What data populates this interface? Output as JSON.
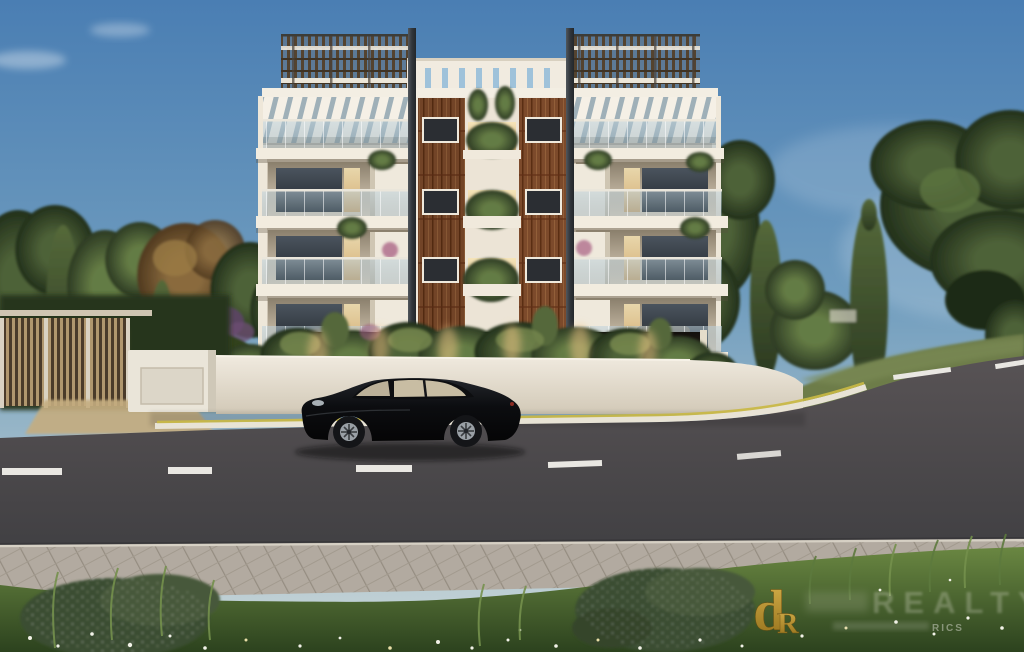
{
  "scene": {
    "subject": "Architectural rendering of a modern four-storey apartment building with wood-clad core, white balconies, roof pergolas, landscaped garden, entrance gate, and a black luxury coupe parked on the street in front"
  },
  "watermark": {
    "monogram_d": "d",
    "monogram_r": "R",
    "brand_text": "REALTY",
    "small_text": "RICS"
  },
  "colors": {
    "sky_top": "#4a7eb3",
    "sky_horizon": "#c9d6d8",
    "building_white": "#f1ebdf",
    "wood_cladding": "#7c4a2b",
    "steel_column": "#383d42",
    "glass_railing": "#9db7c6",
    "warm_interior_light": "#f0d29a",
    "foliage_dark": "#2c3a23",
    "foliage_light": "#74864c",
    "autumn_foliage": "#8a6b3e",
    "asphalt": "#4c4b4e",
    "sidewalk": "#b2aaa0",
    "grass": "#4c6631",
    "curb_line_yellow": "#c9b944",
    "car_black": "#0b0c0e",
    "watermark_gold": "#c79a2e"
  }
}
